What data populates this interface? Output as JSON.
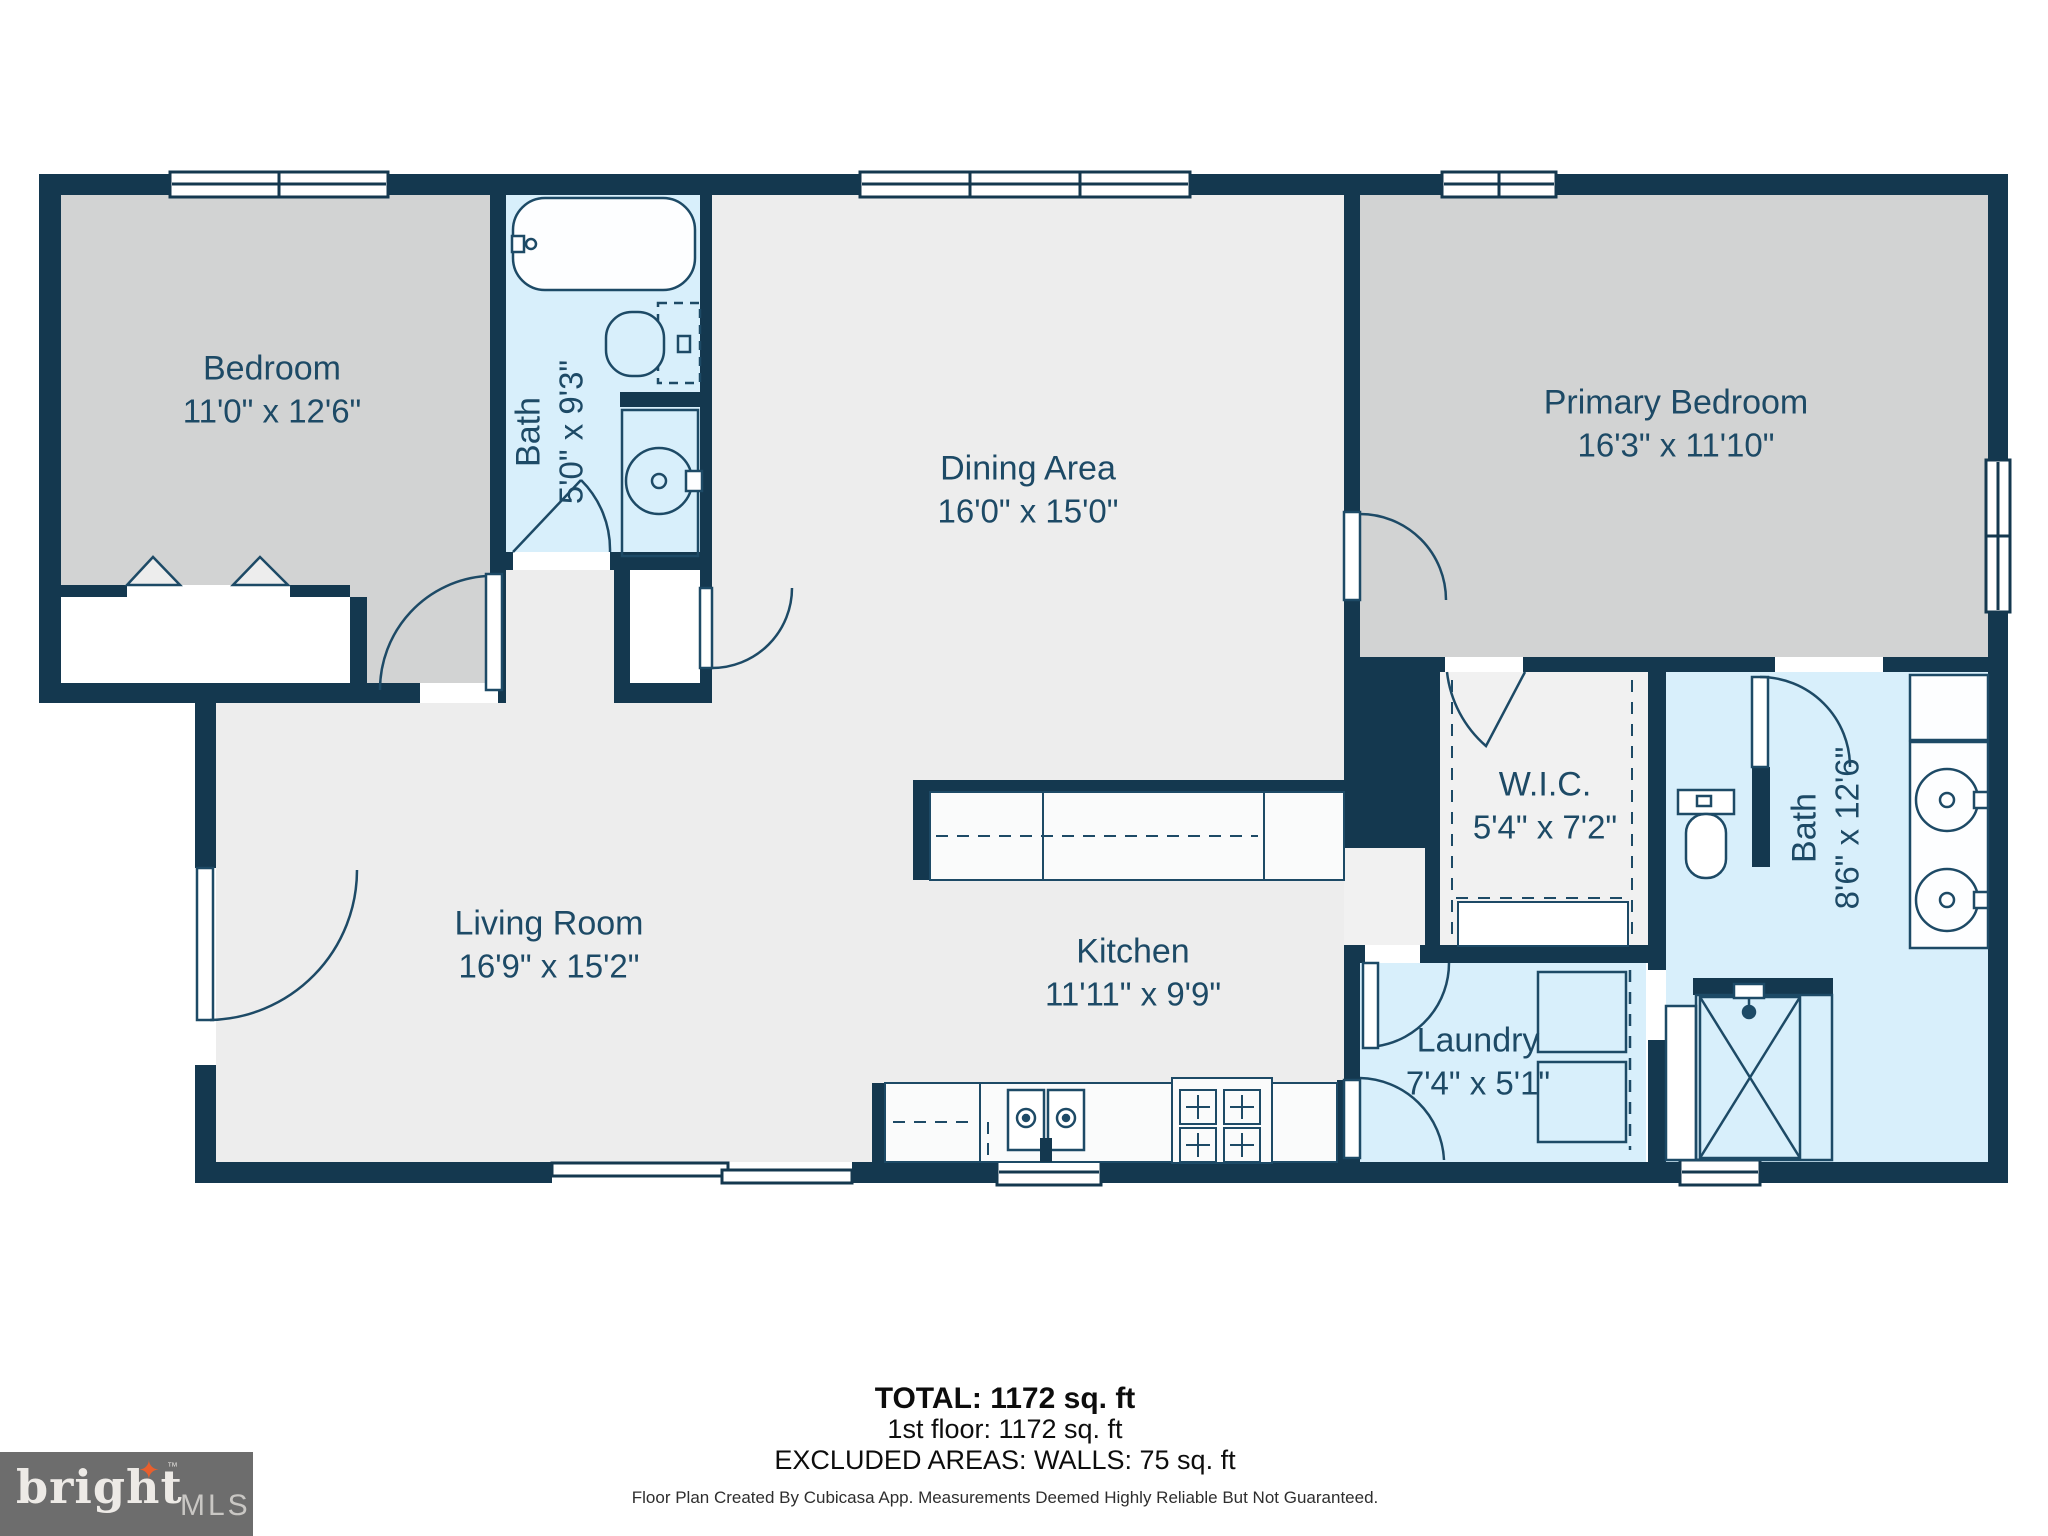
{
  "plan": {
    "rooms": [
      {
        "name": "Bedroom",
        "dims": "11'0\" x 12'6\""
      },
      {
        "name": "Bath",
        "dims": "5'0\" x 9'3\""
      },
      {
        "name": "Dining Area",
        "dims": "16'0\" x 15'0\""
      },
      {
        "name": "Primary Bedroom",
        "dims": "16'3\" x 11'10\""
      },
      {
        "name": "Living Room",
        "dims": "16'9\" x 15'2\""
      },
      {
        "name": "Kitchen",
        "dims": "11'11\" x 9'9\""
      },
      {
        "name": "W.I.C.",
        "dims": "5'4\" x 7'2\""
      },
      {
        "name": "Bath",
        "dims": "8'6\" x 12'6\""
      },
      {
        "name": "Laundry",
        "dims": "7'4\" x 5'1\""
      }
    ],
    "fixtures": [
      "bathtub",
      "toilet",
      "sink-vanity",
      "shower",
      "washer",
      "dryer",
      "stove",
      "kitchen-sink",
      "sliding-door",
      "bifold-closet-doors"
    ],
    "summary": {
      "total": "TOTAL: 1172 sq. ft",
      "first_floor": "1st floor: 1172 sq. ft",
      "excluded": "EXCLUDED AREAS: WALLS: 75 sq. ft"
    },
    "disclaimer": "Floor Plan Created By Cubicasa App. Measurements Deemed Highly Reliable But Not Guaranteed.",
    "logo": {
      "brand": "bright",
      "tm": "TM",
      "suffix": "MLS",
      "star": "✦"
    },
    "colors": {
      "wall": "#14384f",
      "bedroom_floor": "#d2d3d3",
      "living_floor": "#ededed",
      "wet_room_floor": "#d8effb",
      "closet_floor": "#f1f1f1",
      "label_text": "#1d4a66",
      "brand_orange": "#e85f2d",
      "logo_box": "#6d6d6d"
    }
  }
}
